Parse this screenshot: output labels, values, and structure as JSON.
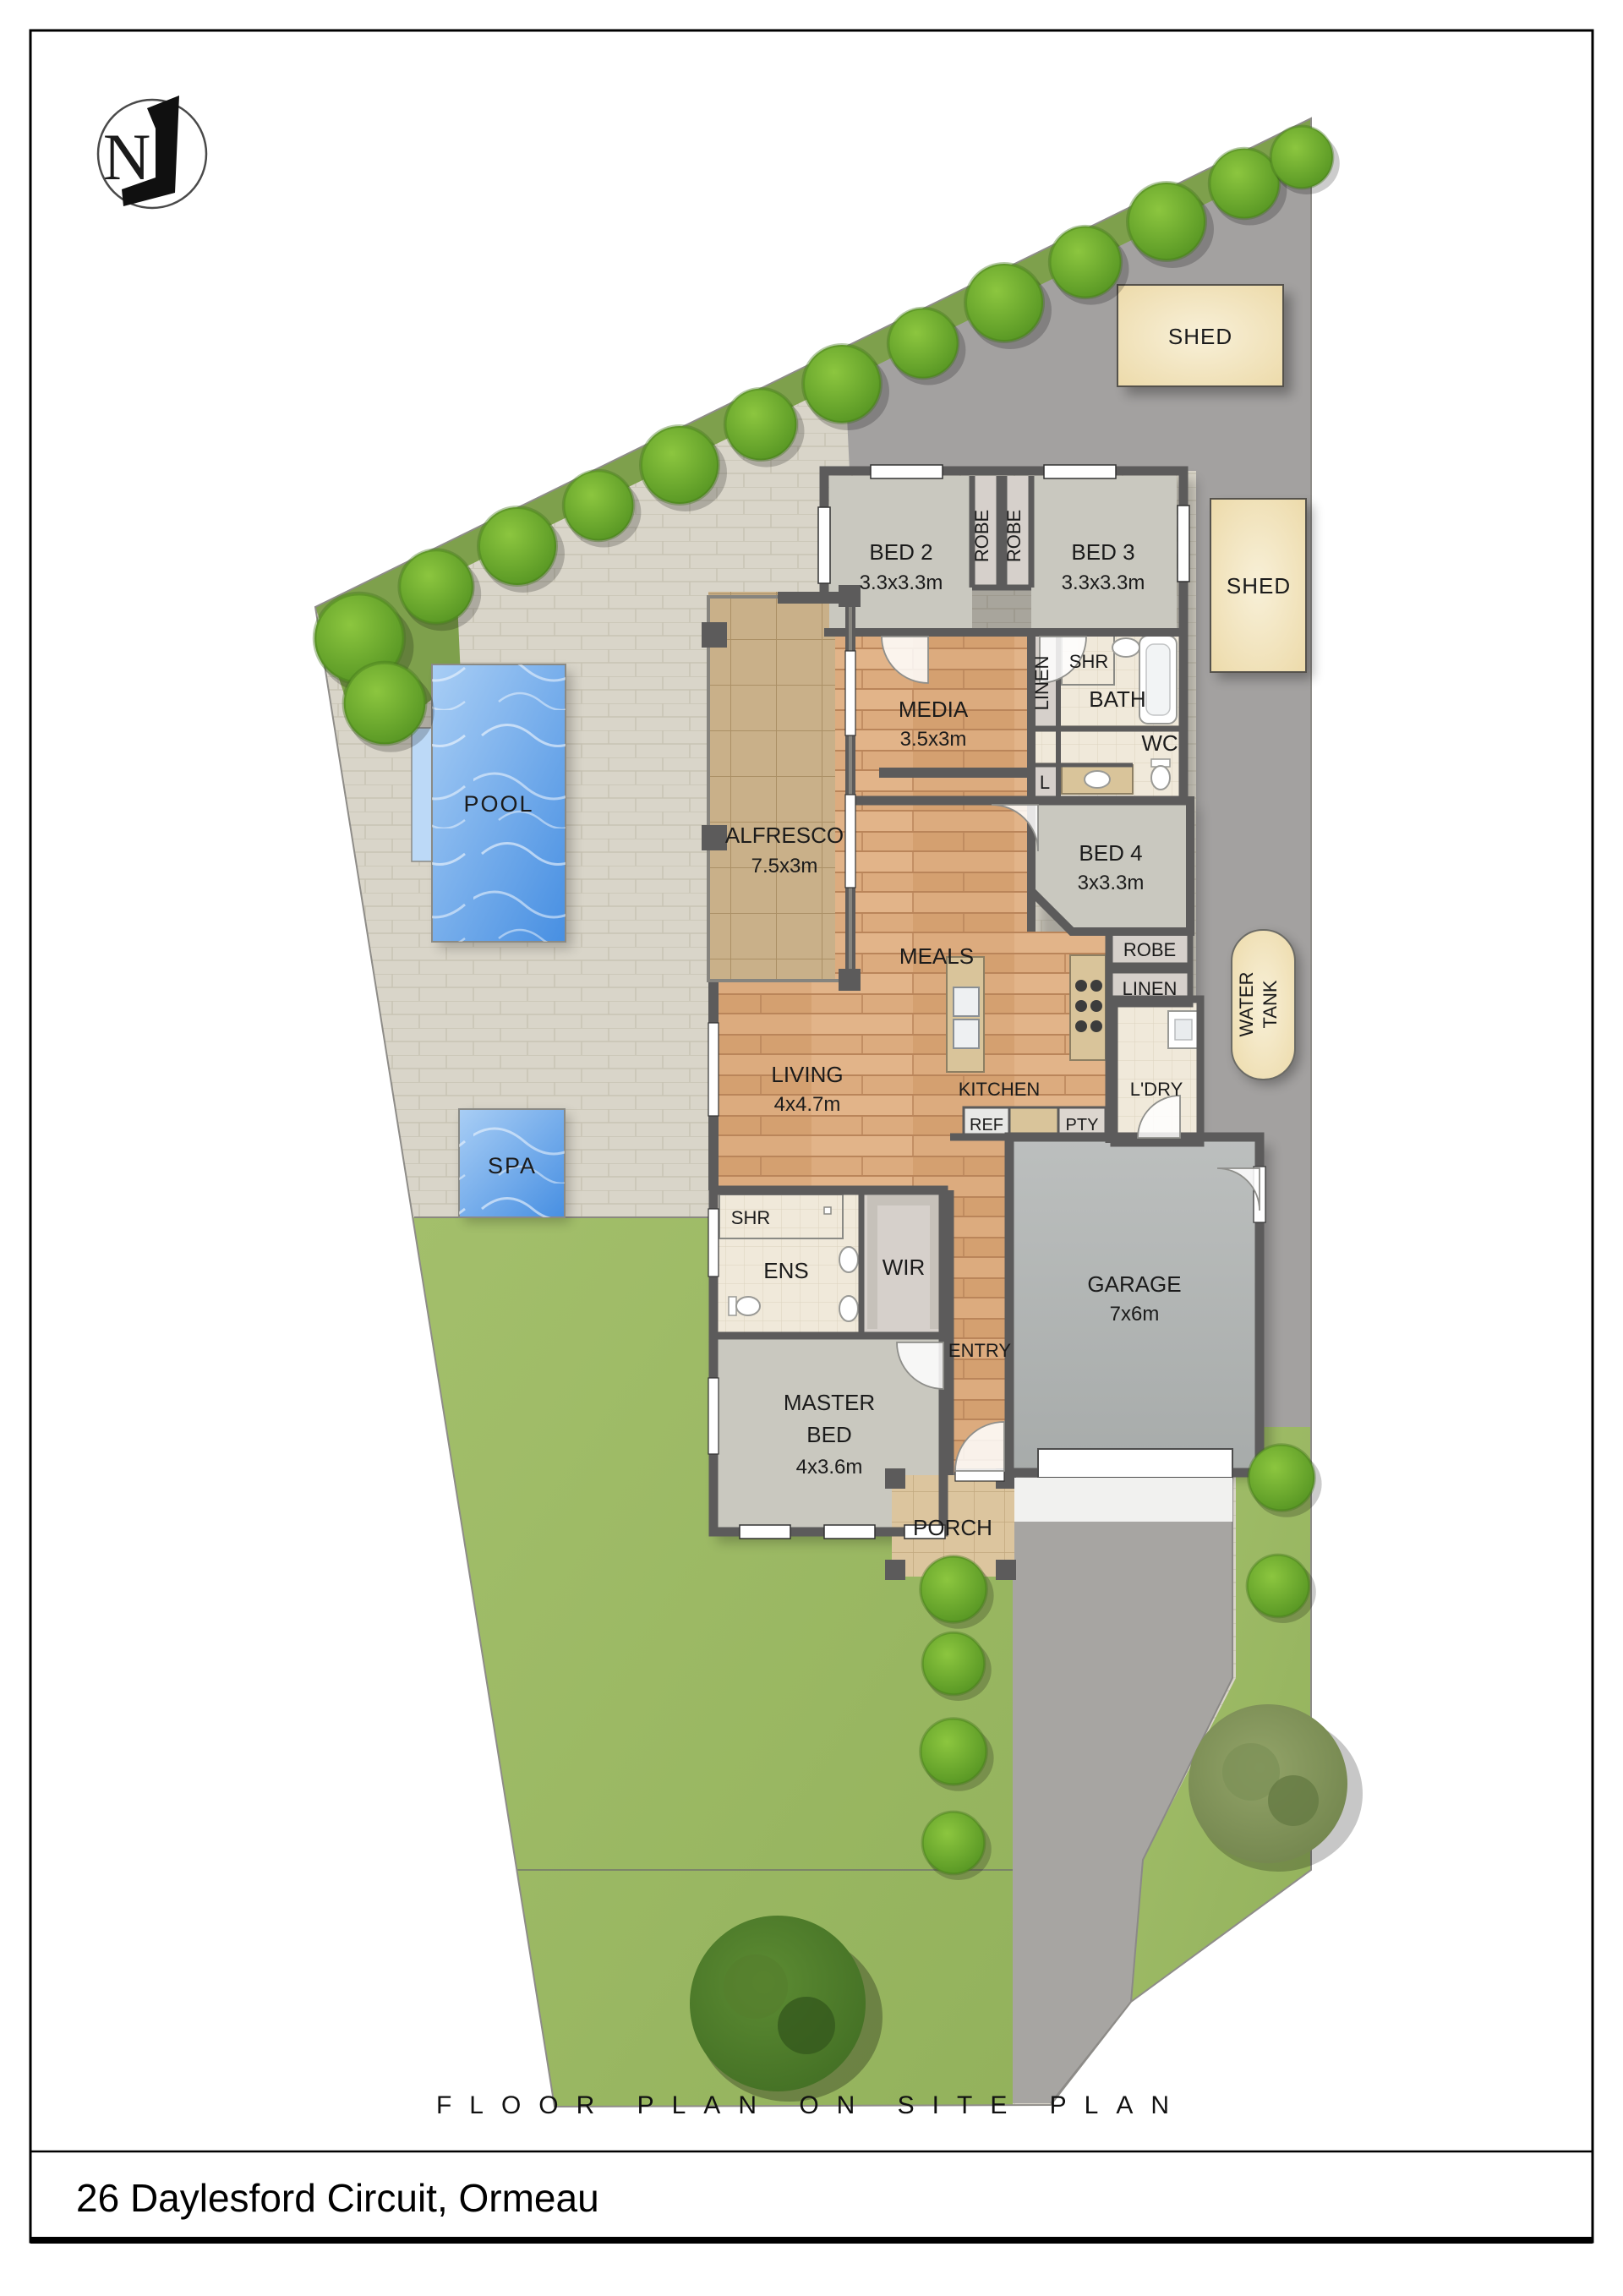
{
  "page": {
    "title": "FLOOR PLAN ON SITE PLAN",
    "address": "26 Daylesford Circuit, Ormeau",
    "north_label": "N"
  },
  "colors": {
    "water_light": "#a9cef5",
    "water_deep": "#478fe2",
    "water_step": "#bcd9f7",
    "lawn": "#a3bf6b",
    "pavers": "#d9d5c9",
    "concrete": "#a3a1a0",
    "driveway": "#a7a5a2",
    "shed_light": "#f8f0d8",
    "shed_dark": "#ecd9a7",
    "wall": "#5c5b5b",
    "wood": "#dcab7e",
    "carpet": "#c9c8bf",
    "tile": "#f0e9da",
    "alfresco_tile": "#c9b089",
    "bush_light": "#8cc63f",
    "bush_dark": "#4f8f1f",
    "tree_dark": "#3f6b22"
  },
  "site": {
    "shed1_label": "SHED",
    "shed2_label": "SHED",
    "water_tank_line1": "WATER",
    "water_tank_line2": "TANK",
    "pool_label": "POOL",
    "spa_label": "SPA"
  },
  "rooms": {
    "bed2": {
      "name": "BED 2",
      "dims": "3.3x3.3m"
    },
    "bed3": {
      "name": "BED 3",
      "dims": "3.3x3.3m"
    },
    "robe_bed2": {
      "name": "ROBE"
    },
    "robe_bed3": {
      "name": "ROBE"
    },
    "media": {
      "name": "MEDIA",
      "dims": "3.5x3m"
    },
    "linen_bath": {
      "name": "LINEN"
    },
    "shr_bath": {
      "name": "SHR"
    },
    "bath": {
      "name": "BATH"
    },
    "wc": {
      "name": "WC"
    },
    "linen_cupboard": {
      "name": "L"
    },
    "bed4": {
      "name": "BED 4",
      "dims": "3x3.3m"
    },
    "robe_bed4": {
      "name": "ROBE"
    },
    "linen_hall": {
      "name": "LINEN"
    },
    "alfresco": {
      "name": "ALFRESCO",
      "dims": "7.5x3m"
    },
    "meals": {
      "name": "MEALS"
    },
    "living": {
      "name": "LIVING",
      "dims": "4x4.7m"
    },
    "kitchen": {
      "name": "KITCHEN"
    },
    "ldry": {
      "name": "L'DRY"
    },
    "ref": {
      "name": "REF"
    },
    "pty": {
      "name": "PTY"
    },
    "garage": {
      "name": "GARAGE",
      "dims": "7x6m"
    },
    "shr_ens": {
      "name": "SHR"
    },
    "ens": {
      "name": "ENS"
    },
    "wir": {
      "name": "WIR"
    },
    "entry": {
      "name": "ENTRY"
    },
    "master": {
      "line1": "MASTER",
      "line2": "BED",
      "dims": "4x3.6m"
    },
    "porch": {
      "name": "PORCH"
    }
  }
}
